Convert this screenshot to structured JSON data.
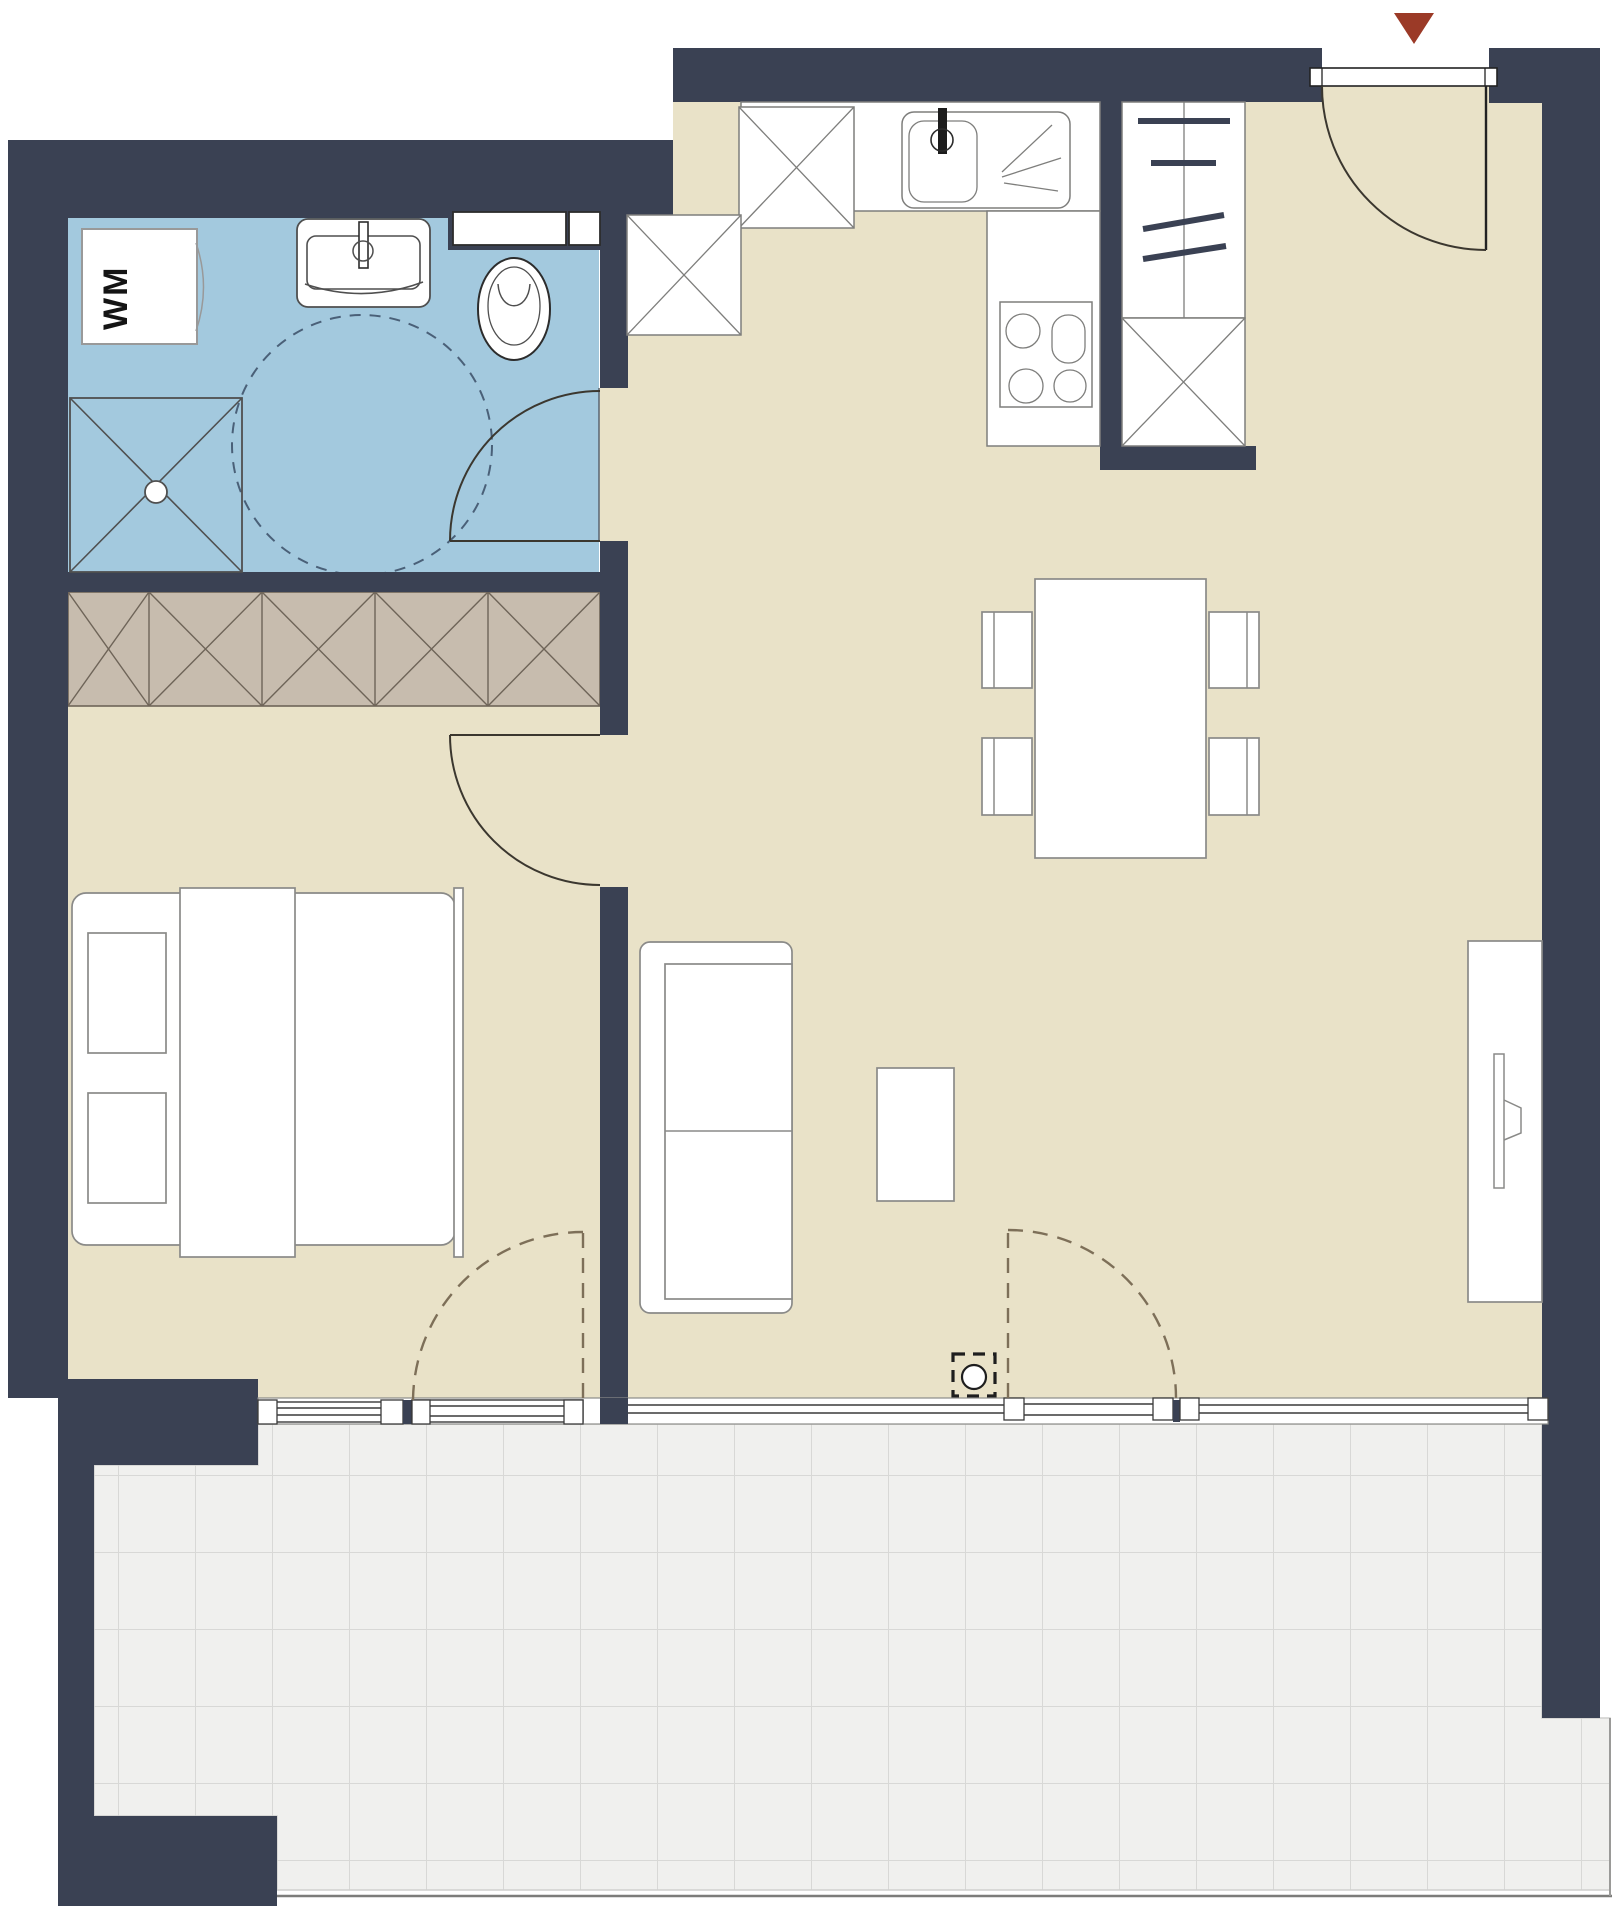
{
  "plan": {
    "type": "apartment-floorplan",
    "labels": {
      "washing_machine": "WM"
    },
    "colors": {
      "wall": "#3a4153",
      "floor": "#e9e2c8",
      "bathroom_floor": "#a3c9de",
      "wardrobe_fill": "#c7bcae",
      "wardrobe_stroke": "#6e6458",
      "tile_fill": "#f0f0ee",
      "tile_grout": "#d8d8d6",
      "fixture_stroke": "#4f4f4f",
      "furniture_stroke": "#8a8a88",
      "door_arc": "#3b372f",
      "dash_swing": "#7d6f58",
      "dash_circle": "#4a6078",
      "entry_marker": "#9b3a27",
      "outside": "#ffffff"
    },
    "rooms": [
      {
        "name": "bathroom",
        "floor": "blue",
        "items": [
          "washing-machine",
          "wash-basin",
          "toilet",
          "shower",
          "turning-circle",
          "door-swing"
        ]
      },
      {
        "name": "bedroom",
        "items": [
          "built-in-wardrobe",
          "double-bed",
          "pillows",
          "duvet",
          "window",
          "balcony-door",
          "door-swing"
        ]
      },
      {
        "name": "kitchen",
        "items": [
          "tall-cabinet",
          "counter",
          "kitchen-sink",
          "drainer",
          "stove-4-burners",
          "base-cabinet"
        ]
      },
      {
        "name": "entry-hall",
        "items": [
          "entrance-door",
          "entrance-marker",
          "closet-with-rails",
          "closet-cabinet"
        ]
      },
      {
        "name": "living-dining",
        "items": [
          "dining-table",
          "dining-chairs-x4",
          "sofa",
          "coffee-table",
          "tv-sideboard",
          "floor-outlet",
          "windows",
          "balcony-door"
        ]
      },
      {
        "name": "terrace",
        "items": [
          "tile-grid"
        ]
      }
    ]
  }
}
